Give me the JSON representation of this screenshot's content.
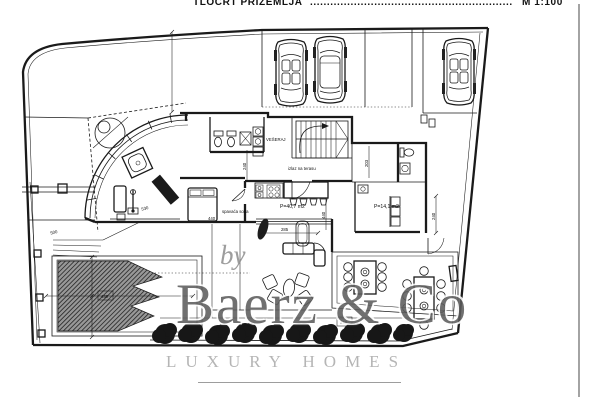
{
  "title": {
    "text": "TLOCRT PRIZEMLJA",
    "leader": "............................................................",
    "scale": "M 1:100"
  },
  "watermark": {
    "by": "by",
    "brand": "Baerz & Co",
    "tagline": "LUXURY HOMES"
  },
  "labels": {
    "laundry": "VEŠERAJ",
    "hall_door": "izlaz na terasu",
    "bedroom": "spavaća soba",
    "area_living": "P=40,7 m2",
    "area_side": "P=14,1 m2"
  },
  "dimensions": {
    "pool_width": "500",
    "pool_box": "440",
    "bench": "530",
    "bed": "440",
    "living_v": "440",
    "hall_v": "240",
    "stair_v": "203",
    "east_v": "240",
    "terrace": "285",
    "terrace_box": "448"
  },
  "colors": {
    "ink": "#1a1a1a",
    "hatch": "#2b2b2b",
    "watermark_gray": "#5d5d5d",
    "tagline_gray": "#b5b5b5"
  }
}
